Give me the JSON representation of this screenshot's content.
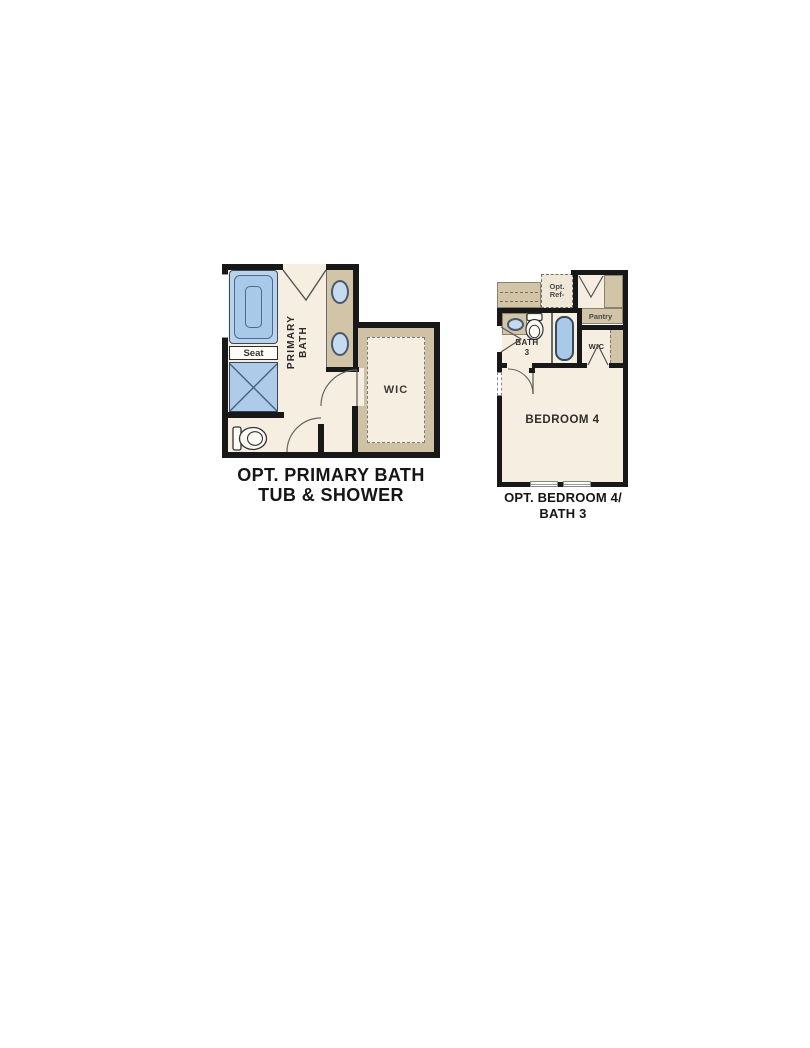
{
  "page": {
    "background": "#ffffff"
  },
  "colors": {
    "wall": "#181818",
    "floor_cream": "#f6eee1",
    "cabinet_tan": "#d2c4a7",
    "fixture_blue": "#a9c9e9",
    "fixture_blue_light": "#c6daf0",
    "caption_text": "#161616"
  },
  "plan_primary_bath": {
    "caption_line1": "OPT. PRIMARY BATH",
    "caption_line2": "TUB & SHOWER",
    "labels": {
      "primary_bath_line1": "PRIMARY",
      "primary_bath_line2": "BATH",
      "seat": "Seat",
      "wic": "WIC"
    },
    "fixtures": [
      "bathtub",
      "shower",
      "toilet",
      "double-sink-vanity"
    ]
  },
  "plan_bedroom4": {
    "caption_line1": "OPT. BEDROOM 4/",
    "caption_line2": "BATH 3",
    "labels": {
      "opt_ref_line1": "Opt.",
      "opt_ref_line2": "Ref-",
      "pantry": "Pantry",
      "bath_line1": "BATH",
      "bath_line2": "3",
      "wic": "WIC",
      "bedroom": "BEDROOM 4"
    },
    "fixtures": [
      "sink",
      "toilet",
      "bathtub"
    ]
  }
}
